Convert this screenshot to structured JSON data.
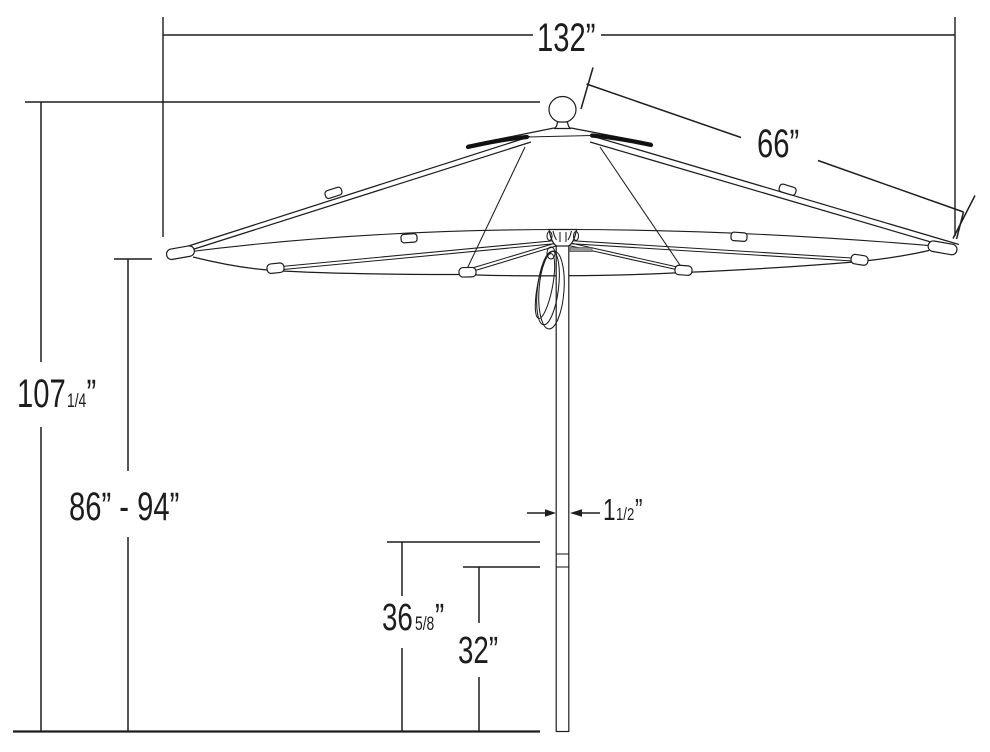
{
  "figure": {
    "kind": "patio-umbrella-dimension-diagram",
    "ink_color": "#1d1d1d",
    "pin_color": "#969696",
    "background": "#ffffff"
  },
  "dimensions": {
    "canopy_width": "132”",
    "rib_length": "66”",
    "overall_height": {
      "whole": "107",
      "fraction": "1/4",
      "unit": "”"
    },
    "clearance_range": "86” - 94”",
    "lower_pole_height": {
      "whole": "36",
      "fraction": "5/8",
      "unit": "”"
    },
    "base_pole_height": "32”",
    "pole_diameter": {
      "whole": "1",
      "fraction": "1/2",
      "unit": "”"
    }
  }
}
